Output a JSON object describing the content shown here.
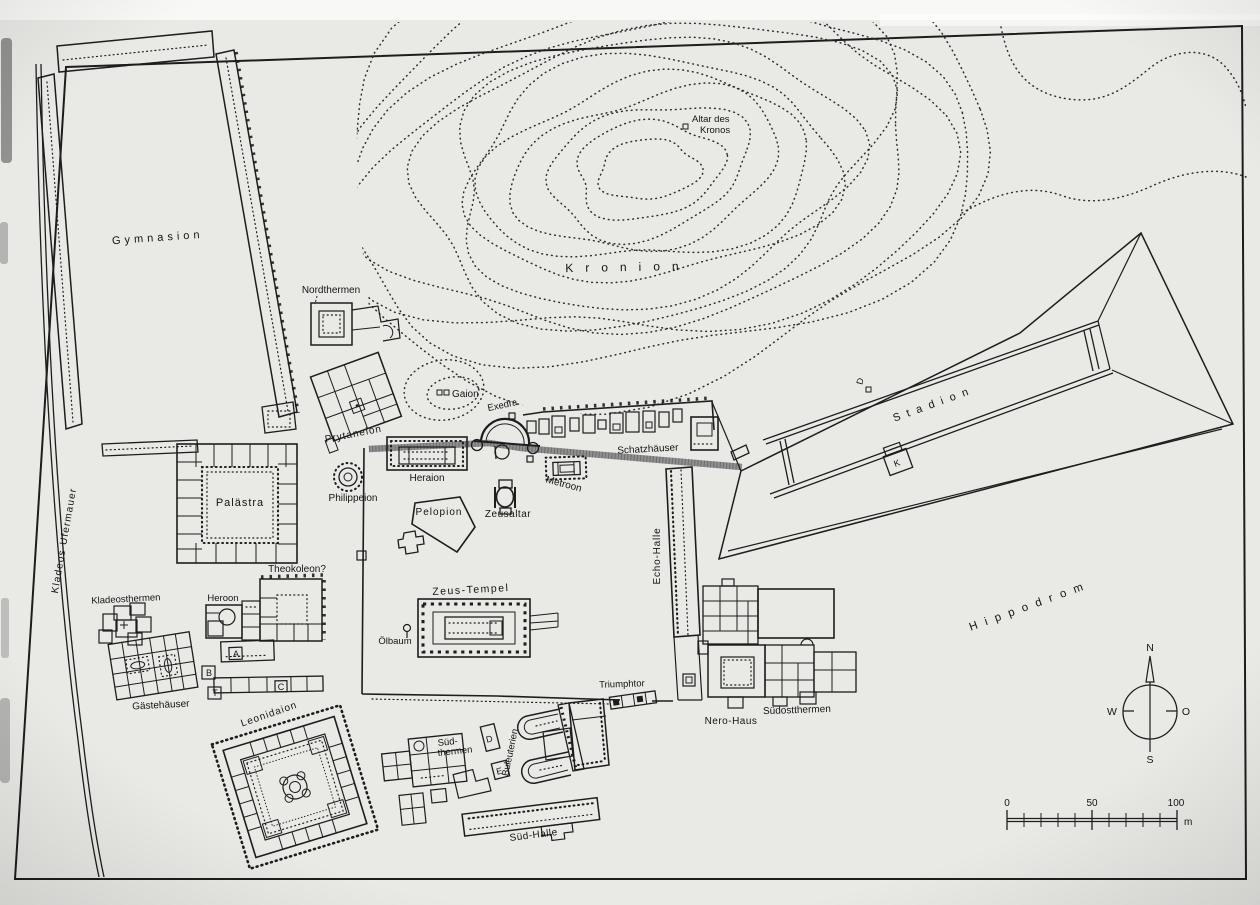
{
  "map": {
    "labels": {
      "kladeos_ufermauer": "Kladeos-Ufermauer",
      "gymnasion": "Gymnasion",
      "nordthermen": "Nordthermen",
      "altar_des_kronos_1": "Altar des",
      "altar_des_kronos_2": "Kronos",
      "kronion": "Kronion",
      "gaion": "Gaion",
      "exedra": "Exedra",
      "prytaneion": "Prytaneion",
      "schatzhaeuser": "Schatzhäuser",
      "philippeion": "Philippeion",
      "heraion": "Heraion",
      "metroon": "Metroon",
      "pelopion": "Pelopion",
      "zeusaltar": "Zeusaltar",
      "palaestra": "Palästra",
      "stadion": "Stadion",
      "echo_halle": "Echo-Halle",
      "theokoleon": "Theokoleon?",
      "heroon": "Heroon",
      "kladeosthermen": "Kladeosthermen",
      "gaestehaeuser": "Gästehäuser",
      "zeus_tempel": "Zeus-Tempel",
      "oelbaum": "Ölbaum",
      "leonidaion": "Leonidaion",
      "sued_thermen_1": "Süd-",
      "sued_thermen_2": "thermen",
      "buleuterien": "Buleuterien",
      "sued_halle": "Süd-Halle",
      "triumphtor": "Triumphtor",
      "nero_haus": "Nero-Haus",
      "suedostthermen": "Südostthermen",
      "hippodrom": "Hippodrom"
    },
    "markers": {
      "a": "A",
      "b": "B",
      "c": "C",
      "t": "T",
      "d": "D",
      "e": "E",
      "k": "K",
      "d_stadion": "D"
    },
    "compass": {
      "north": "N",
      "west": "W",
      "east": "O",
      "south": "S"
    },
    "scale_bar": {
      "start": "0",
      "middle": "50",
      "end": "100",
      "unit": "m"
    },
    "colors": {
      "ink": "#1d1d1d",
      "paper": "#e9e9e6",
      "terrace_band": "#8f8f8f"
    }
  }
}
